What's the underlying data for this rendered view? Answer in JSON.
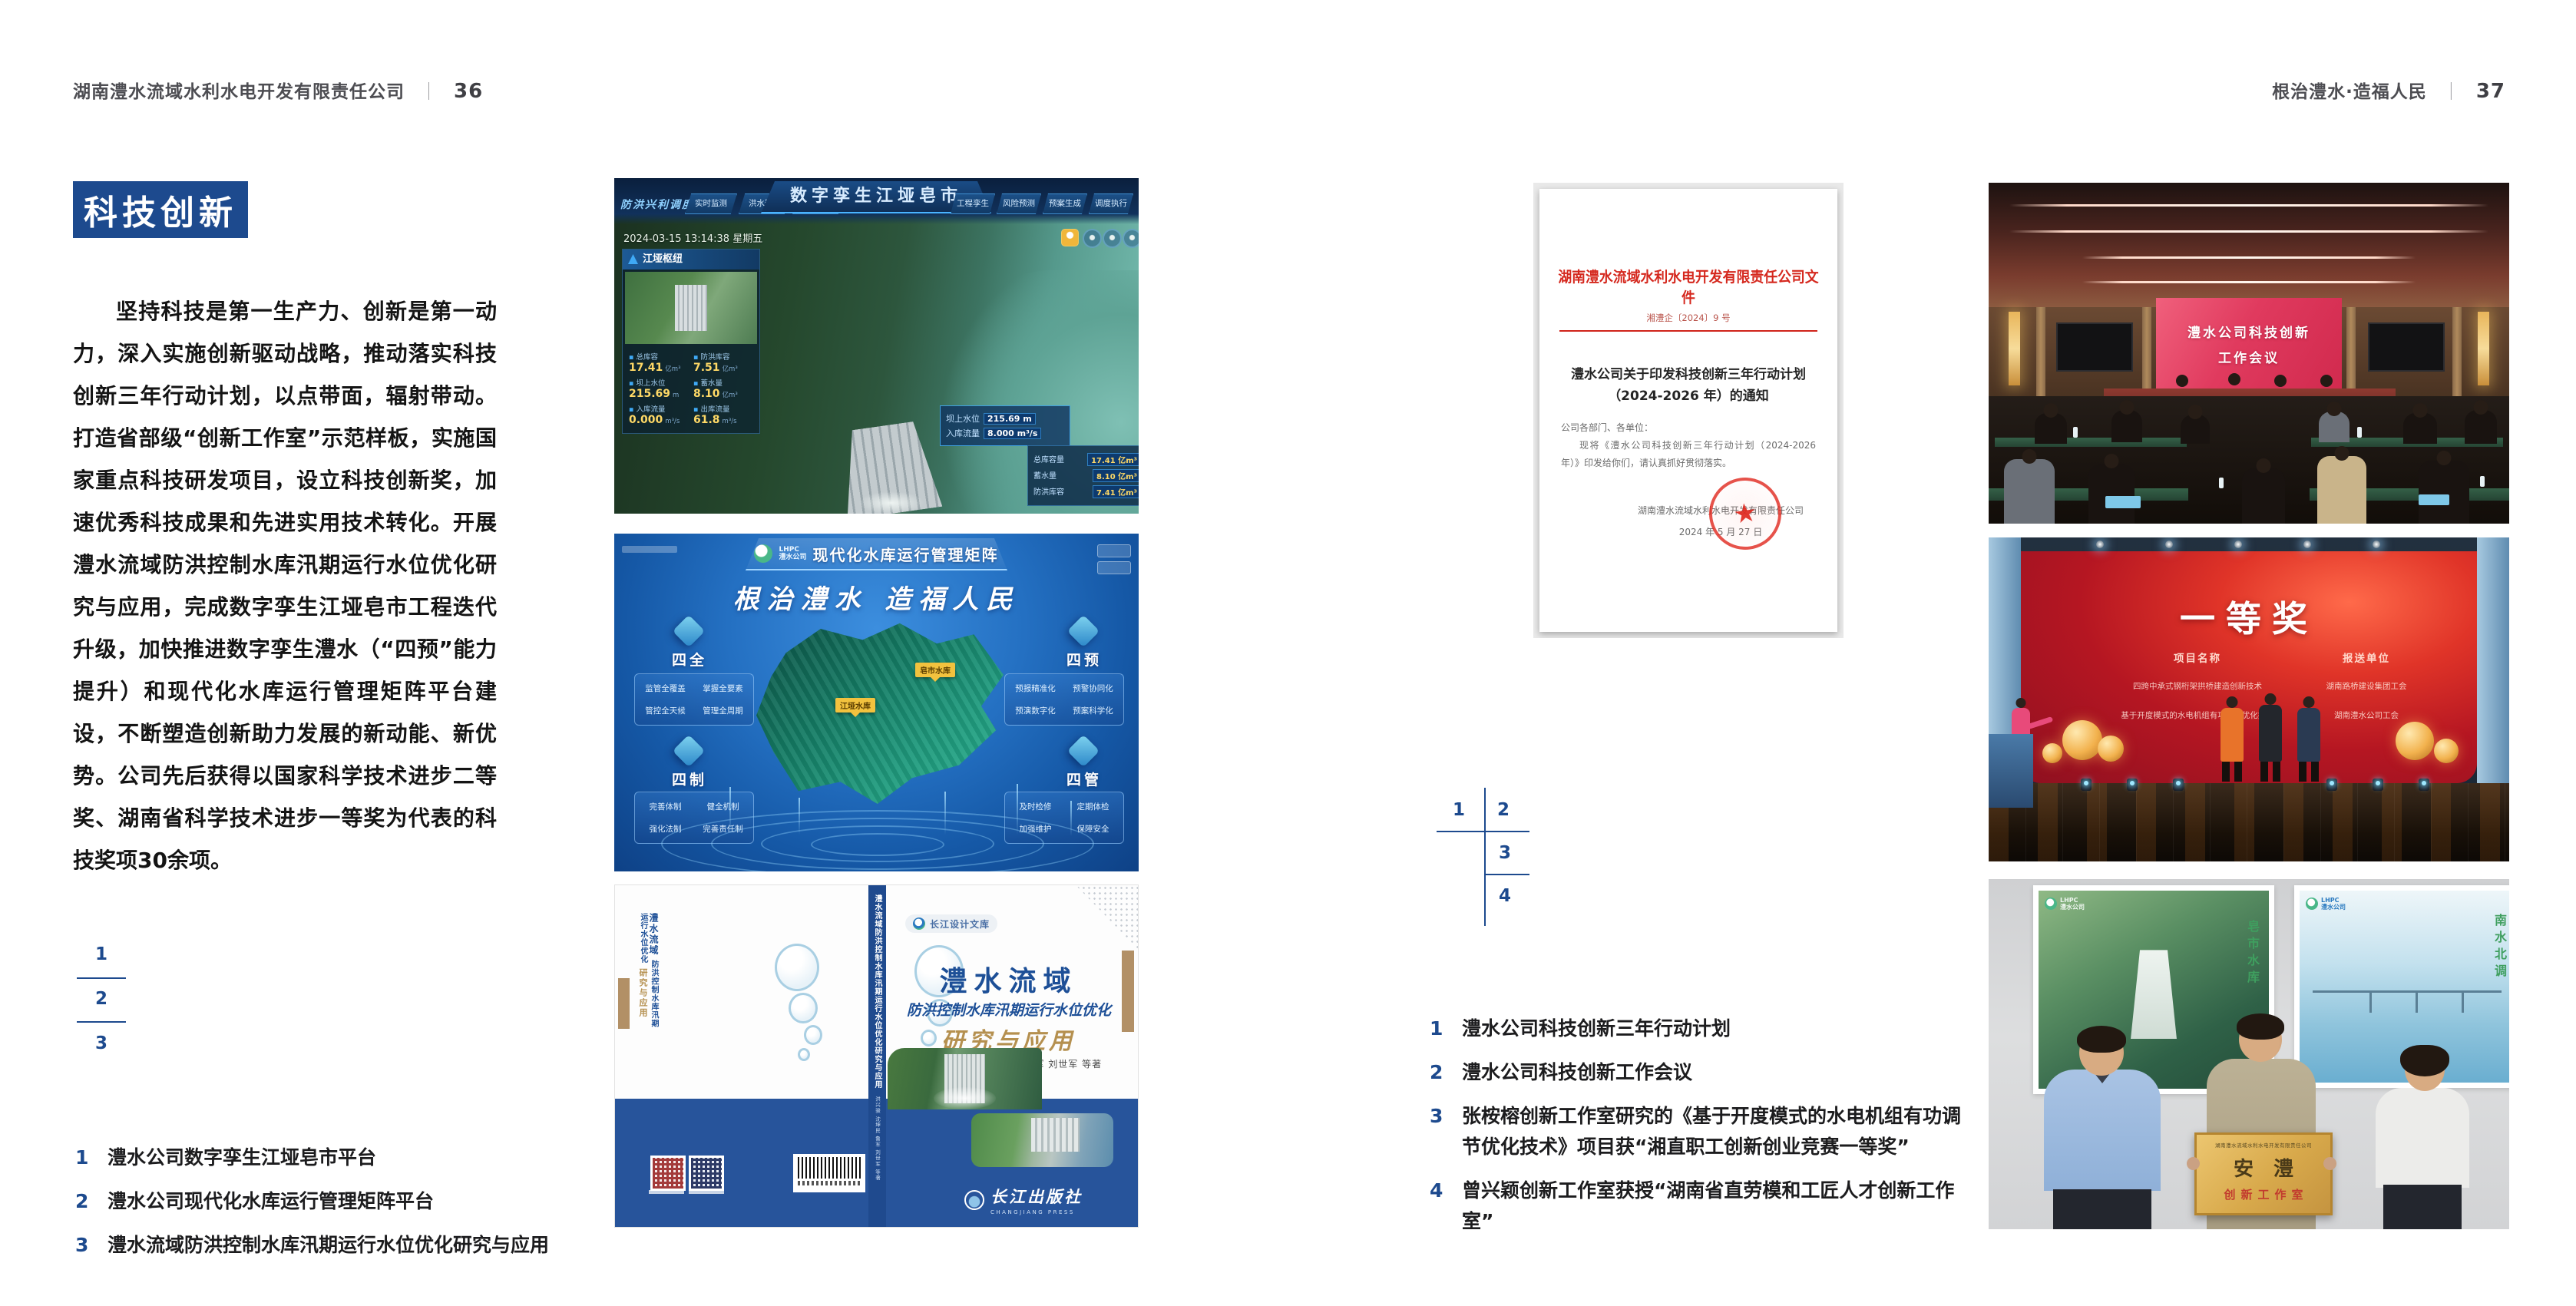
{
  "header_left": {
    "company": "湖南澧水流域水利水电开发有限责任公司",
    "divider": "｜",
    "page": "36"
  },
  "header_right": {
    "slogan": "根治澧水·造福人民",
    "divider": "｜",
    "page": "37"
  },
  "section": {
    "title": "科技创新",
    "body": "坚持科技是第一生产力、创新是第一动力，深入实施创新驱动战略，推动落实科技创新三年行动计划，以点带面，辐射带动。打造省部级“创新工作室”示范样板，实施国家重点科技研发项目，设立科技创新奖，加速优秀科技成果和先进实用技术转化。开展澧水流域防洪控制水库汛期运行水位优化研究与应用，完成数字孪生江垭皂市工程迭代升级，加快推进数字孪生澧水（“四预”能力提升）和现代化水库运行管理矩阵平台建设，不断塑造创新助力发展的新动能、新优势。公司先后获得以国家科学技术进步二等奖、湖南省科学技术进步一等奖为代表的科技奖项30余项。"
  },
  "left_map": {
    "n1": "1",
    "n2": "2",
    "n3": "3"
  },
  "right_map": {
    "n1": "1",
    "n2": "2",
    "n3": "3",
    "n4": "4"
  },
  "left_captions": [
    {
      "num": "1",
      "text": "澧水公司数字孪生江垭皂市平台"
    },
    {
      "num": "2",
      "text": "澧水公司现代化水库运行管理矩阵平台"
    },
    {
      "num": "3",
      "text": "澧水流域防洪控制水库汛期运行水位优化研究与应用"
    }
  ],
  "right_captions": [
    {
      "num": "1",
      "text": "澧水公司科技创新三年行动计划"
    },
    {
      "num": "2",
      "text": "澧水公司科技创新工作会议"
    },
    {
      "num": "3",
      "text": "张桉榕创新工作室研究的《基于开度模式的水电机组有功调节优化技术》项目获“湘直职工创新创业竞赛一等奖”"
    },
    {
      "num": "4",
      "text": "曾兴颖创新工作室获授“湖南省直劳模和工匠人才创新工作室”"
    }
  ],
  "dashboard": {
    "corner_label": "防洪兴利调度",
    "title": "数字孪生江垭皂市",
    "tabs_left": [
      "实时监测",
      "洪水预报",
      "防洪预警"
    ],
    "tabs_right": [
      "风险预测",
      "预案生成",
      "调度执行",
      "工程孪生"
    ],
    "datetime": "2024-03-15 13:14:38 星期五",
    "panel_title": "江垭枢纽",
    "stats": [
      {
        "label": "总库容",
        "value": "17.41",
        "unit": "亿m³"
      },
      {
        "label": "防洪库容",
        "value": "7.51",
        "unit": "亿m³"
      },
      {
        "label": "坝上水位",
        "value": "215.69",
        "unit": "m"
      },
      {
        "label": "蓄水量",
        "value": "8.10",
        "unit": "亿m³"
      },
      {
        "label": "入库流量",
        "value": "0.000",
        "unit": "m³/s"
      },
      {
        "label": "出库流量",
        "value": "61.8",
        "unit": "m³/s"
      }
    ],
    "tag": {
      "l1": "坝上水位",
      "v1": "215.69 m",
      "l2": "入库流量",
      "v2": "8.000 m³/s"
    },
    "panel2": [
      {
        "label": "总库容量",
        "value": "17.41 亿m³"
      },
      {
        "label": "蓄水量",
        "value": "8.10 亿m³"
      },
      {
        "label": "防洪库容",
        "value": "7.41 亿m³"
      }
    ]
  },
  "platform": {
    "logo_top": "LHPC",
    "logo_sub": "澧水公司",
    "title": "现代化水库运行管理矩阵",
    "slogan": "根治澧水 造福人民",
    "marker1": "皂市水库",
    "marker2": "江垭水库",
    "groups": [
      {
        "label": "四全",
        "items": [
          "监管全覆盖",
          "掌握全要素",
          "管控全天候",
          "管理全周期"
        ]
      },
      {
        "label": "四预",
        "items": [
          "预报精准化",
          "预警协同化",
          "预演数字化",
          "预案科学化"
        ]
      },
      {
        "label": "四制",
        "items": [
          "完善体制",
          "健全机制",
          "强化法制",
          "完善责任制"
        ]
      },
      {
        "label": "四管",
        "items": [
          "及时检修",
          "定期体检",
          "加强维护",
          "保障安全"
        ]
      }
    ]
  },
  "book": {
    "series": "长江设计文库",
    "title": "澧水流域",
    "subtitle": "防洪控制水库汛期运行水位优化",
    "subtitle2": "研究与应用",
    "authors": "洪兴骏  沈坤民  鲁军  刘世军  等著",
    "spine_title": "澧水流域防洪控制水库汛期运行水位优化研究与应用",
    "spine_authors": "洪兴骏 沈坤民 鲁军 刘世军 等著",
    "back_t1": "澧水流域",
    "back_t2": "防洪控制水库汛期运行水位优化",
    "back_t3": "研究与应用",
    "publisher": "长江出版社",
    "publisher_en": "CHANGJIANG PRESS"
  },
  "document": {
    "header": "湖南澧水流域水利水电开发有限责任公司文件",
    "doc_no": "湘澧企〔2024〕9 号",
    "title_line1": "澧水公司关于印发科技创新三年行动计划",
    "title_line2": "（2024-2026 年）的通知",
    "salutation": "公司各部门、各单位：",
    "body": "现将《澧水公司科技创新三年行动计划（2024-2026 年）》印发给你们，请认真抓好贯彻落实。",
    "signer": "湖南澧水流域水利水电开发有限责任公司",
    "date": "2024 年 5 月 27 日",
    "seal_star": "★"
  },
  "meeting": {
    "line1": "澧水公司科技创新",
    "line2": "工作会议"
  },
  "award": {
    "title": "一等奖",
    "col1": "项目名称",
    "col2": "报送单位",
    "p1": "四跨中承式钢桁架拱桥建造创新技术",
    "p2": "基于开度模式的水电机组有功调节优化技术",
    "u1": "湖南路桥建设集团工会",
    "u2": "湖南澧水公司工会"
  },
  "plaque": {
    "org": "湖南澧水流域水利水电开发有限责任公司",
    "big": "安澧",
    "sub": "创新工作室",
    "poster_logo_top": "LHPC",
    "poster_logo_sub": "澧水公司",
    "posterL_text": "皂市水库",
    "posterR_text": "南水北调"
  }
}
